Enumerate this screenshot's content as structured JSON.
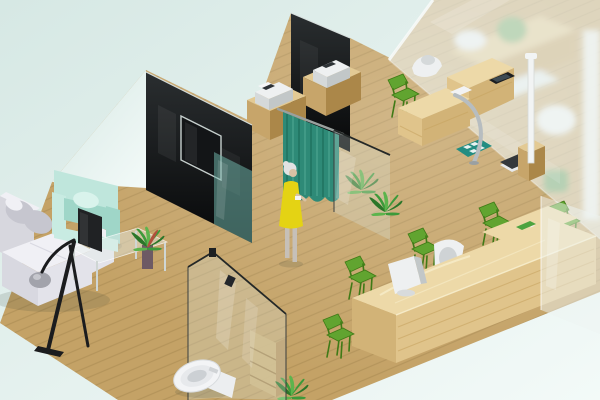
{
  "scene": {
    "type": "3d-isometric-interior-render",
    "description": "Isometric 3D rendering of a small clinic office interior: waiting area with white sectional sofa, mint armchair, glass coffee table and floor lamp; wall-mounted TV on a black glass partition; teal privacy curtain with a woman in a yellow dress standing beside it; wooden cabinets with printer devices; examination desk with instruments, height-measuring station, weight scale and teal floor mat behind a frosted glass wall; long blond-wood reception counter lined with green chairs, a white office chair and a white monitor; potted plants; and a toilet with storage shelf behind a clear glass partition, all on light wood plank flooring against a pale mint background.",
    "objects": [
      "mint-background",
      "wood-plank-floor",
      "black-glass-partition-left",
      "wall-mounted-tv",
      "black-glass-partition-back",
      "teal-tinted-glass",
      "teal-privacy-curtain",
      "standing-woman",
      "potted-plant",
      "printer-cabinet",
      "printer-device",
      "examination-desk",
      "desk-instruments",
      "tablet-device",
      "chrome-grab-bar",
      "height-measuring-pole",
      "weight-scale",
      "teal-floor-mat",
      "green-visitor-chair",
      "frosted-glass-wall",
      "glass-partition",
      "reception-counter",
      "reception-monitor",
      "white-office-chair",
      "green-desk-tray",
      "waiting-sofa",
      "gray-cushions",
      "mint-armchair",
      "glass-coffee-table",
      "table-monitor",
      "table-plant-vase",
      "floor-lamp",
      "toilet",
      "storage-shelf"
    ]
  },
  "colors": {
    "bg_top": "#d6e8e4",
    "bg_bottom": "#f3faf8",
    "floor": "#c4a266",
    "floor_grain": "#8f7340",
    "wall_top": "#2a2e30",
    "wall_bottom": "#070809",
    "wall_edge": "#d7dfdd",
    "tv_frame": "#c6cfcd",
    "tv_screen": "#131517",
    "teal_glass": "rgba(110,176,166,0.55)",
    "curtain": "#2e8a77",
    "curtain_dark": "#1b6a58",
    "curtain_light": "#4fa892",
    "rail": "#9aa09e",
    "wood_top": "#e3ca94",
    "wood_front": "#c7a56a",
    "wood_side": "#ab8749",
    "desk_top": "#edd9a8",
    "desk_front": "#e0c48b",
    "desk_side": "#d2b377",
    "desk_stripe": "#c7a360",
    "device_white": "#eef0f1",
    "device_front": "#d5d9da",
    "device_side": "#c2c7c8",
    "device_screen": "#2d3236",
    "chair_green": "#61a430",
    "chair_green_dark": "#3f7a16",
    "plant": "#3c9a3a",
    "plant_dark": "#2b7629",
    "plant_light": "#5cb44d",
    "sofa_white": "#f0f0f5",
    "sofa_front": "#e3e3ea",
    "sofa_end": "#d8d8e0",
    "sofa_back": "#d7d7de",
    "cushion_gray": "#c6c6cf",
    "armchair": "#bfe6dc",
    "armchair_inner": "#9fd6c8",
    "armchair_lip": "#c8ebe2",
    "pillow": "#d9f3ec",
    "dress_yellow": "#e4d314",
    "hair_gray": "#e2e2e2",
    "skin": "#d9c2a4",
    "legs_gray": "#c6c0b8",
    "toilet_white": "#f3f4f6",
    "toilet_rim": "#e7e9ec",
    "toilet_inner": "#ccd0d4",
    "tank": "#eceef0",
    "mat_teal": "#238d82",
    "mat_tile": "#e9f3f1",
    "scale_dark": "#34383b",
    "pole_white": "#f2f4f4",
    "dish_green": "#4da33f",
    "monitor_dark": "#202224",
    "lamp_black": "#1b1c1e",
    "dome_gray": "#a2a3ab",
    "chrome": "#b7bdc0",
    "frosted": "rgba(238,244,243,0.58)",
    "pane": "rgba(220,235,231,0.28)",
    "right_glass": "rgba(237,243,241,0.50)",
    "shelf_front": "#cfb277",
    "shelf_side": "#b8935a",
    "vase": "#6d5a64",
    "shadow": "rgba(40,55,48,0.14)"
  }
}
